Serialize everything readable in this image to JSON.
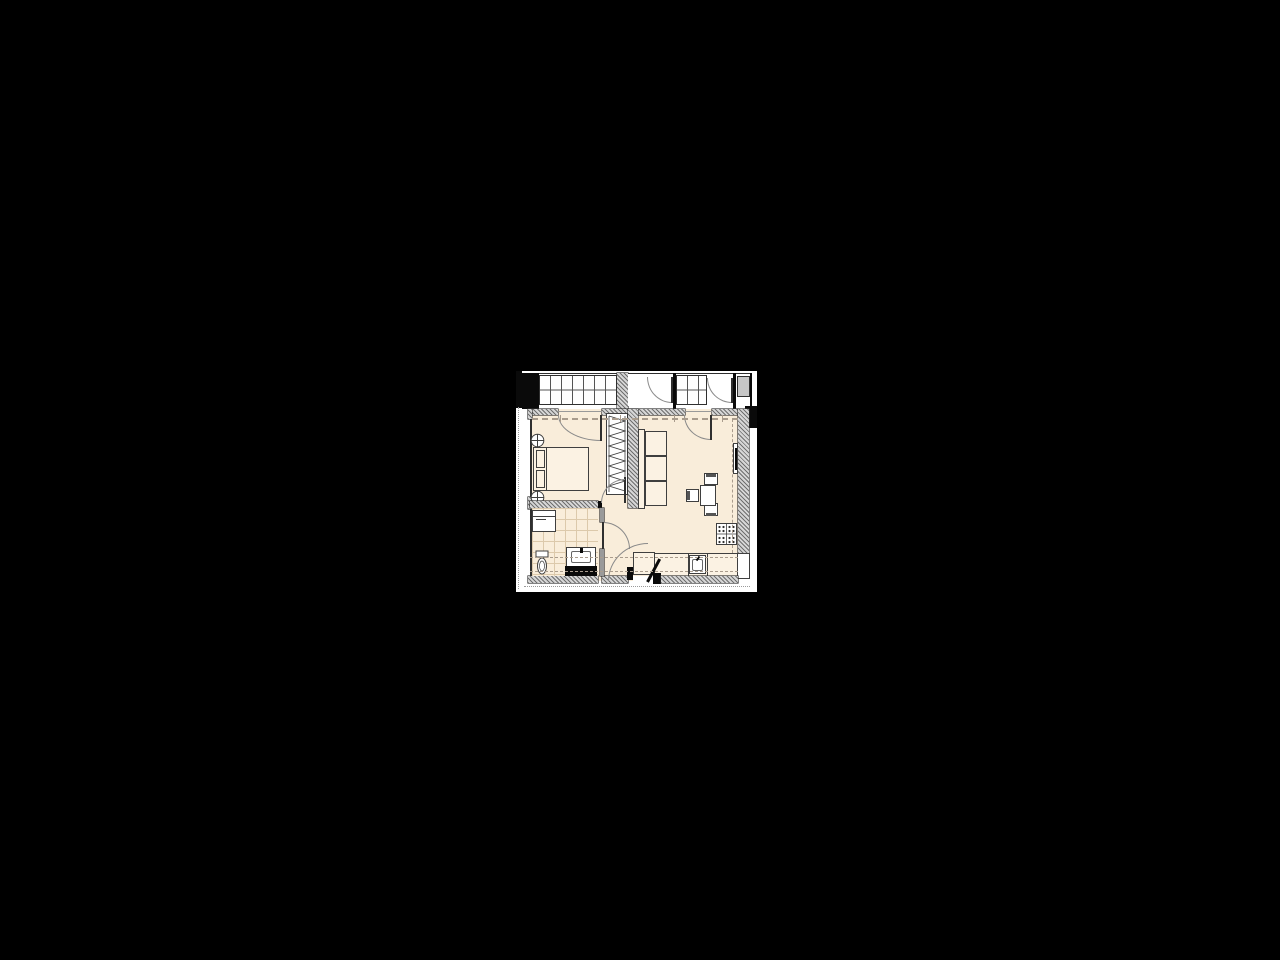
{
  "document": {
    "kind": "architectural-floor-plan",
    "description": "One-bedroom apartment floor plan with glazed balcony, drawn on a small white sheet centered on a black canvas",
    "visible_text": ""
  },
  "palette": {
    "canvas": "#000000",
    "paper": "#ffffff",
    "floor": "#f9edda",
    "furn_fill": "#fbf2e3",
    "wall_edge": "#2f2f2f",
    "solid": "#0a0a0a",
    "stroke": "#3f3f3f",
    "arc": "#8a8a8a",
    "dash": "#a99c8d",
    "tile": "#dcc9ab",
    "cab": "#c6c6c6",
    "hatch_d": "#6f6f6f",
    "hatch_l": "#d6d6d6"
  },
  "symbols": [
    "balcony-glazing-grid",
    "solid-wall-pier",
    "hatched-wall",
    "balcony-cabinet",
    "door-swing-arc",
    "entrance-door-leaf",
    "double-bed",
    "pillows",
    "bedside-stool",
    "wardrobe-hangers",
    "three-seat-sofa",
    "wall-tv",
    "dining-table",
    "dining-chair",
    "cooktop-burners",
    "kitchen-counter",
    "kitchen-sink",
    "washing-machine",
    "toilet",
    "washbasin-vanity",
    "tiled-bathroom-floor",
    "axis-dashed-line"
  ]
}
